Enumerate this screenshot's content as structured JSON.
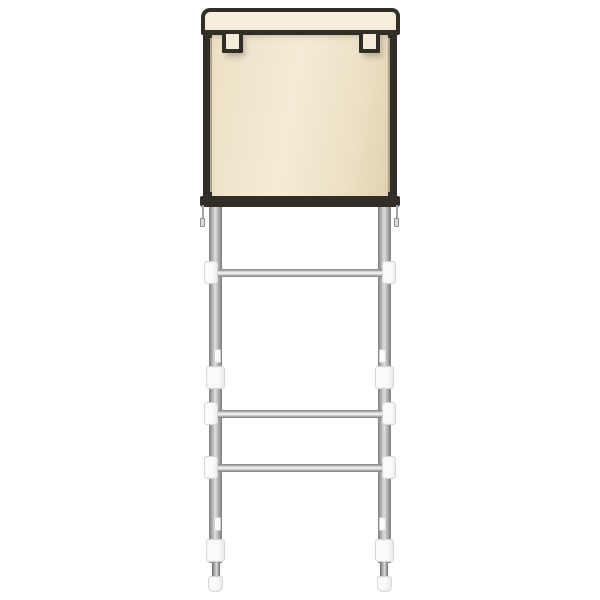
{
  "scene": {
    "type": "product-photo",
    "subject": "Over-the-toilet storage rack with zippered fabric cover (cream) on a 2-leg metal frame",
    "background_color": "#ffffff",
    "visible_text": []
  },
  "theme": {
    "bg": "#ffffff",
    "fabric": "#ece0c4",
    "fabric-light": "#f4ecd6",
    "fabric-dark": "#e1d3b0",
    "trim": "#312e28",
    "zip-tape": "#c8bfa8",
    "metal-edge": "#7d7d7d",
    "metal-mid": "#b9b9b9",
    "metal-light": "#e0e0e0",
    "metal-dark": "#6f6f6f",
    "white-part": "#fbfbfb",
    "part-edge": "#d6d6d6",
    "shadow": "rgba(100,95,82,0.35)"
  },
  "product": {
    "cover": {
      "description": "fabric cabinet cover with top lid flap and black piping trim",
      "fabric_color": "#ece0c4",
      "trim_color": "#312e28",
      "hanging_tabs": 2,
      "zipper_pulls": 2
    },
    "frame": {
      "description": "silver telescoping tube frame",
      "legs": 2,
      "crossbars": 3,
      "leg_color": "#b9b9b9",
      "connector_color": "#fbfbfb",
      "adjustment_sleeves": 4,
      "foot_caps": 2
    }
  }
}
